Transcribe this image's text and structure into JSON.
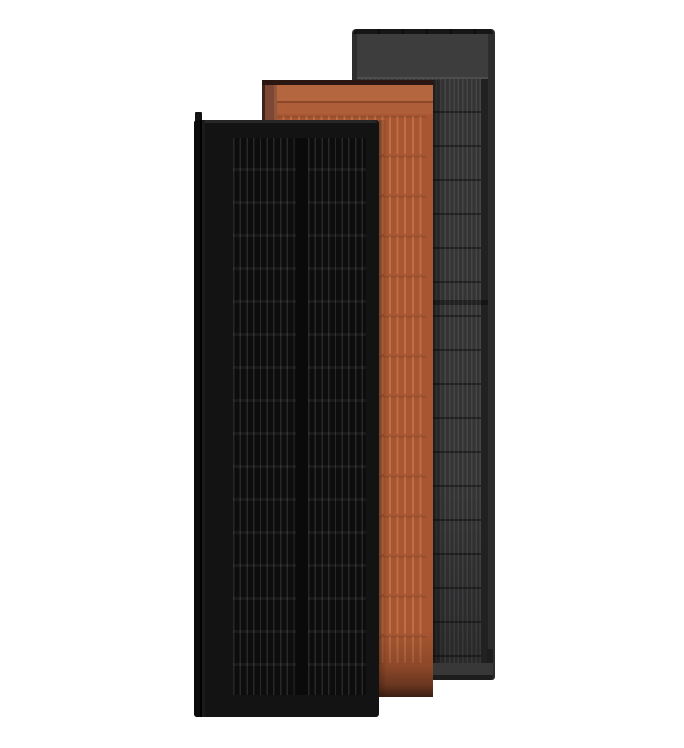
{
  "scene": {
    "background_color": "#ffffff",
    "panels": [
      {
        "id": "gray",
        "semantic": "dark-gray-solar-roof-panel",
        "colors": {
          "frame": "#2d2d2d",
          "bar": "#161616",
          "bar_notch": "rgba(0,0,0,0.55)",
          "header": "#3d3d3d",
          "header_line": "#4d4d4d",
          "base": "#343434",
          "line": "#464648",
          "row_line": "rgba(0,0,0,0.38)",
          "side_shade": "rgba(0,0,0,0.25)",
          "seam": "rgba(0,0,0,0.35)",
          "bottom_frame": "#383838",
          "bottom_edge": "#1d1d1d",
          "cast_shadow": "rgba(0,0,0,0.45)"
        }
      },
      {
        "id": "terracotta",
        "semantic": "terracotta-solar-roof-panel",
        "colors": {
          "top_edge": "#2b1712",
          "left_frame_outer": "#3f2419",
          "left_frame": "#7c4734",
          "left_frame_hi": "#93573c",
          "header": "#b4663f",
          "header_seam": "rgba(0,0,0,0.16)",
          "header_lower": "#ae5f3a",
          "base": "#a75631",
          "rib": "#bd6f45",
          "row_tick": "rgba(0,0,0,0.12)",
          "shade_mid": "rgba(89,45,26,0.35)",
          "shade_deep": "rgba(64,33,20,0.6)",
          "shade_end": "rgba(40,21,13,0.85)",
          "cast_shadow": "rgba(0,0,0,0.28)"
        }
      },
      {
        "id": "black",
        "semantic": "black-solar-roof-panel",
        "colors": {
          "frame": "#131313",
          "lip": "#272727",
          "cap_dark": "#0b0b0b",
          "cap_groove": "#000000",
          "cap_inner": "#1a1a1a",
          "base": "#0d0d0d",
          "gap": "#0a0a0a",
          "line": "#28282b",
          "row_band": "rgba(255,255,255,0.05)"
        }
      }
    ]
  }
}
